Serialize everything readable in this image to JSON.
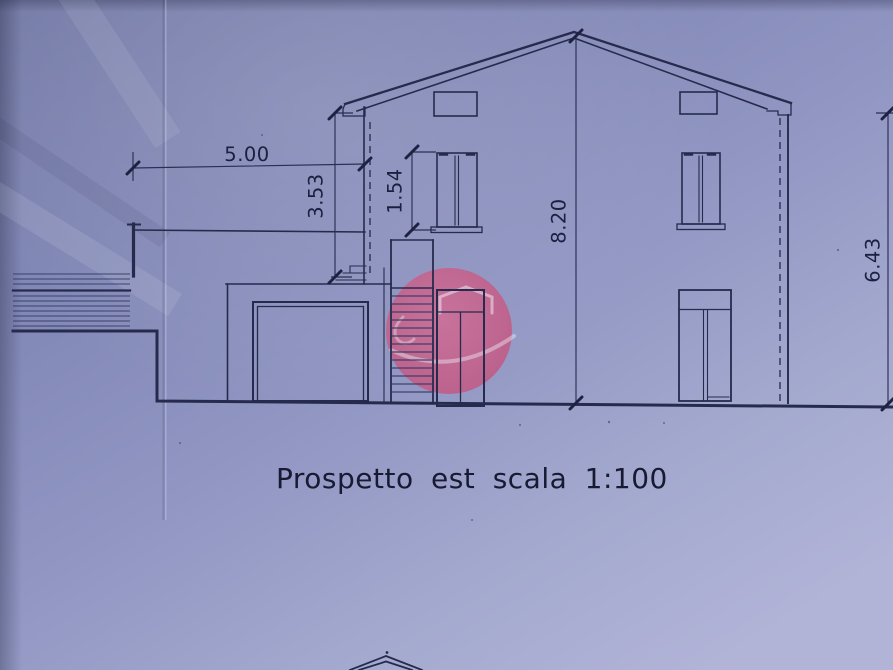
{
  "drawing": {
    "title": "Prospetto est scala 1:100",
    "dims": {
      "garage_width": "5.00",
      "garage_parapet_height": "3.53",
      "window_height": "1.54",
      "ridge_height": "8.20",
      "eave_height": "6.43"
    },
    "colors": {
      "paper_blue": "#8b91bf",
      "ink_navy": "#262b4e",
      "watermark_pink": "#c7608a"
    },
    "watermark_icon": "house-sketch-circle-icon"
  }
}
